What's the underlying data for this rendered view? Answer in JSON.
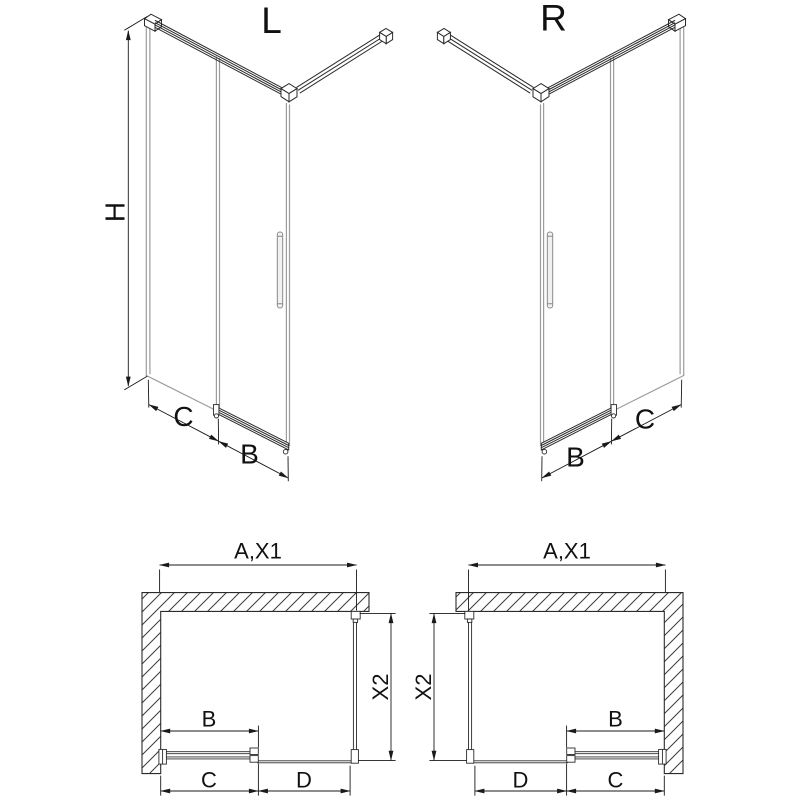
{
  "colors": {
    "background": "#ffffff",
    "structure_line": "#2b2b2b",
    "glass_line": "#9c9c9c",
    "dimension_line": "#1a1a1a",
    "wall_hatch": "#3a3a3a",
    "text": "#111111"
  },
  "views": {
    "iso_left": {
      "label": "L",
      "dim_height": "H",
      "dim_front_fixed": "C",
      "dim_door": "B"
    },
    "iso_right": {
      "label": "R",
      "dim_door": "B",
      "dim_front_fixed": "C"
    },
    "plan_left": {
      "dim_width": "A,X1",
      "dim_depth": "X2",
      "dim_door_width": "B",
      "dim_bottom_left": "C",
      "dim_bottom_right": "D"
    },
    "plan_right": {
      "dim_width": "A,X1",
      "dim_depth": "X2",
      "dim_door_width": "B",
      "dim_bottom_left": "D",
      "dim_bottom_right": "C"
    }
  }
}
